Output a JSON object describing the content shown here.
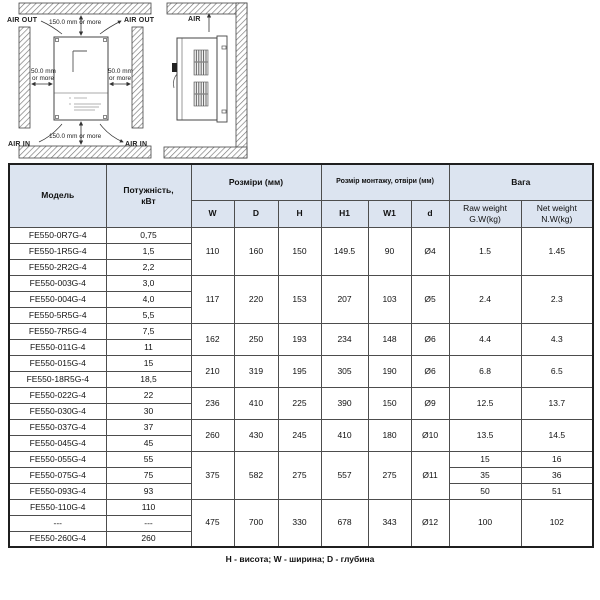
{
  "diagram": {
    "front_view": {
      "air_out_left": "AIR OUT",
      "air_out_right": "AIR OUT",
      "air_in_left": "AIR IN",
      "air_in_right": "AIR IN",
      "top_clearance": "150.0 mm or more",
      "bottom_clearance": "150.0 mm or more",
      "left_clearance_1": "50.0 mm",
      "left_clearance_2": "or more",
      "right_clearance_1": "50.0 mm",
      "right_clearance_2": "or more"
    },
    "side_view": {
      "air_label": "AIR"
    }
  },
  "table": {
    "headers": {
      "model": "Модель",
      "power_line1": "Потужність,",
      "power_line2": "кВт",
      "dimensions": "Розміри (мм)",
      "mounting": "Розмір монтажу, отвіри  (мм)",
      "weight": "Вага",
      "w": "W",
      "d": "D",
      "h": "H",
      "h1": "H1",
      "w1": "W1",
      "hole": "d",
      "raw_line1": "Raw weight",
      "raw_line2": "G.W(kg)",
      "net_line1": "Net weight",
      "net_line2": "N.W(kg)"
    },
    "groups": [
      {
        "rows": [
          {
            "model": "FE550-0R7G-4",
            "power": "0,75"
          },
          {
            "model": "FE550-1R5G-4",
            "power": "1,5"
          },
          {
            "model": "FE550-2R2G-4",
            "power": "2,2"
          }
        ],
        "w": "110",
        "d": "160",
        "h": "150",
        "h1": "149.5",
        "w1": "90",
        "hole": "Ø4",
        "gw": "1.5",
        "nw": "1.45"
      },
      {
        "rows": [
          {
            "model": "FE550-003G-4",
            "power": "3,0"
          },
          {
            "model": "FE550-004G-4",
            "power": "4,0"
          },
          {
            "model": "FE550-5R5G-4",
            "power": "5,5"
          }
        ],
        "w": "117",
        "d": "220",
        "h": "153",
        "h1": "207",
        "w1": "103",
        "hole": "Ø5",
        "gw": "2.4",
        "nw": "2.3"
      },
      {
        "rows": [
          {
            "model": "FE550-7R5G-4",
            "power": "7,5"
          },
          {
            "model": "FE550-011G-4",
            "power": "11"
          }
        ],
        "w": "162",
        "d": "250",
        "h": "193",
        "h1": "234",
        "w1": "148",
        "hole": "Ø6",
        "gw": "4.4",
        "nw": "4.3"
      },
      {
        "rows": [
          {
            "model": "FE550-015G-4",
            "power": "15"
          },
          {
            "model": "FE550-18R5G-4",
            "power": "18,5"
          }
        ],
        "w": "210",
        "d": "319",
        "h": "195",
        "h1": "305",
        "w1": "190",
        "hole": "Ø6",
        "gw": "6.8",
        "nw": "6.5"
      },
      {
        "rows": [
          {
            "model": "FE550-022G-4",
            "power": "22"
          },
          {
            "model": "FE550-030G-4",
            "power": "30"
          }
        ],
        "w": "236",
        "d": "410",
        "h": "225",
        "h1": "390",
        "w1": "150",
        "hole": "Ø9",
        "gw": "12.5",
        "nw": "13.7"
      },
      {
        "rows": [
          {
            "model": "FE550-037G-4",
            "power": "37"
          },
          {
            "model": "FE550-045G-4",
            "power": "45"
          }
        ],
        "w": "260",
        "d": "430",
        "h": "245",
        "h1": "410",
        "w1": "180",
        "hole": "Ø10",
        "gw": "13.5",
        "nw": "14.5"
      },
      {
        "rows": [
          {
            "model": "FE550-055G-4",
            "power": "55"
          },
          {
            "model": "FE550-075G-4",
            "power": "75"
          },
          {
            "model": "FE550-093G-4",
            "power": "93"
          }
        ],
        "w": "375",
        "d": "582",
        "h": "275",
        "h1": "557",
        "w1": "275",
        "hole": "Ø11",
        "gw": [
          "15",
          "35",
          "50"
        ],
        "nw": [
          "16",
          "36",
          "51"
        ]
      },
      {
        "rows": [
          {
            "model": "FE550-110G-4",
            "power": "110"
          },
          {
            "model": "---",
            "power": "---"
          },
          {
            "model": "FE550-260G-4",
            "power": "260"
          }
        ],
        "w": "475",
        "d": "700",
        "h": "330",
        "h1": "678",
        "w1": "343",
        "hole": "Ø12",
        "gw": "100",
        "nw": "102"
      }
    ],
    "footnote": "Н - висота; W - ширина;  D -  глубина"
  },
  "colors": {
    "header_bg": "#dce4f0",
    "border": "#4d4d4d",
    "wall_hatch": "#777777"
  }
}
